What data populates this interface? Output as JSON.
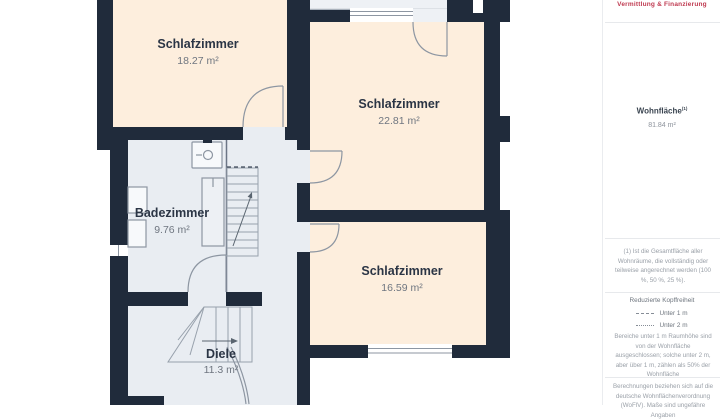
{
  "panel": {
    "brand_tagline": "Vermittlung & Finanzierung",
    "brand_color": "#bf3a50",
    "living_area": {
      "label": "Wohnfläche",
      "marker": "(1)",
      "value": "81.84 m²"
    },
    "footnote": "(1) Ist die Gesamtfläche aller Wohnräume, die vollständig oder teilweise angerechnet werden (100 %, 50 %, 25 %).",
    "headroom": {
      "title": "Reduzierte Kopffreiheit",
      "legend": [
        {
          "line_style": "dashed",
          "label": "Unter 1 m"
        },
        {
          "line_style": "dotted",
          "label": "Unter 2 m"
        }
      ],
      "note": "Bereiche unter 1 m Raumhöhe sind von der Wohnfläche ausgeschlossen; solche unter 2 m, aber über 1 m, zählen als 50% der Wohnfläche"
    },
    "disclaimer": "Berechnungen beziehen sich auf die deutsche Wohnflächenverordnung (WoFlV). Maße sind ungefähre Angaben"
  },
  "floorplan": {
    "rooms": [
      {
        "name": "Schlafzimmer",
        "area": "18.27 m²"
      },
      {
        "name": "Schlafzimmer",
        "area": "22.81 m²"
      },
      {
        "name": "Schlafzimmer",
        "area": "16.59 m²"
      },
      {
        "name": "Badezimmer",
        "area": "9.76 m²"
      },
      {
        "name": "Diele",
        "area": "11.3 m²"
      }
    ],
    "colors": {
      "wall": "#202b3b",
      "room": "#fdeedd",
      "wet_room": "#e9edf2"
    }
  }
}
